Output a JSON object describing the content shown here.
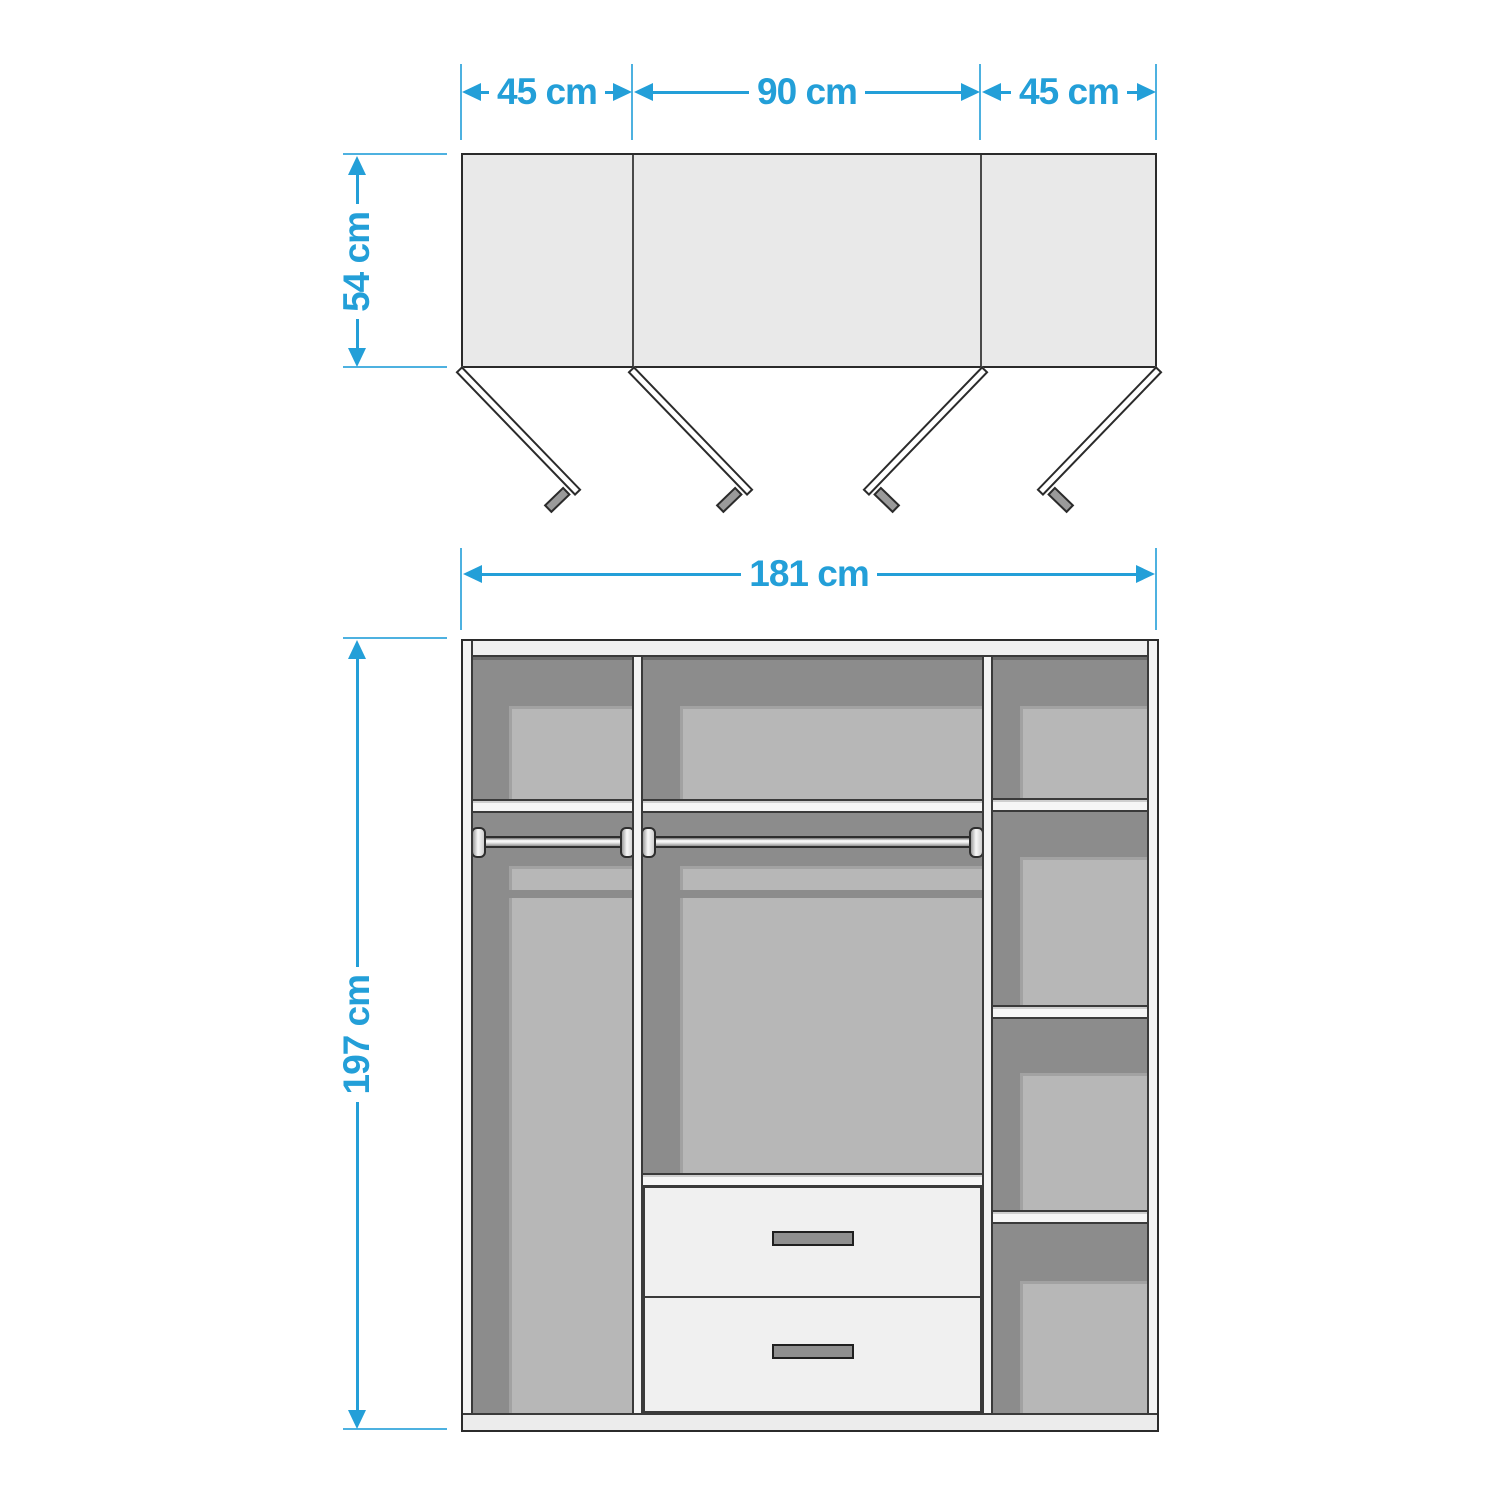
{
  "colors": {
    "dimension": "#239fd8",
    "extension_line": "#4db1e0",
    "outline": "#2e2e2e",
    "top_view_fill": "#e9e9e9",
    "interior_dark": "#8c8c8c",
    "interior_light": "#b7b7b7",
    "panel_light": "#f2f2f2",
    "handle_gray": "#8f8f8f"
  },
  "top_view": {
    "section_widths": [
      {
        "label": "45 cm"
      },
      {
        "label": "90 cm"
      },
      {
        "label": "45 cm"
      }
    ],
    "depth": {
      "label": "54 cm"
    },
    "door_count": 4
  },
  "front_view": {
    "overall_width": {
      "label": "181 cm"
    },
    "overall_height": {
      "label": "197 cm"
    },
    "drawer_count": 2,
    "hanging_rail_count": 2,
    "right_shelf_count": 3
  }
}
